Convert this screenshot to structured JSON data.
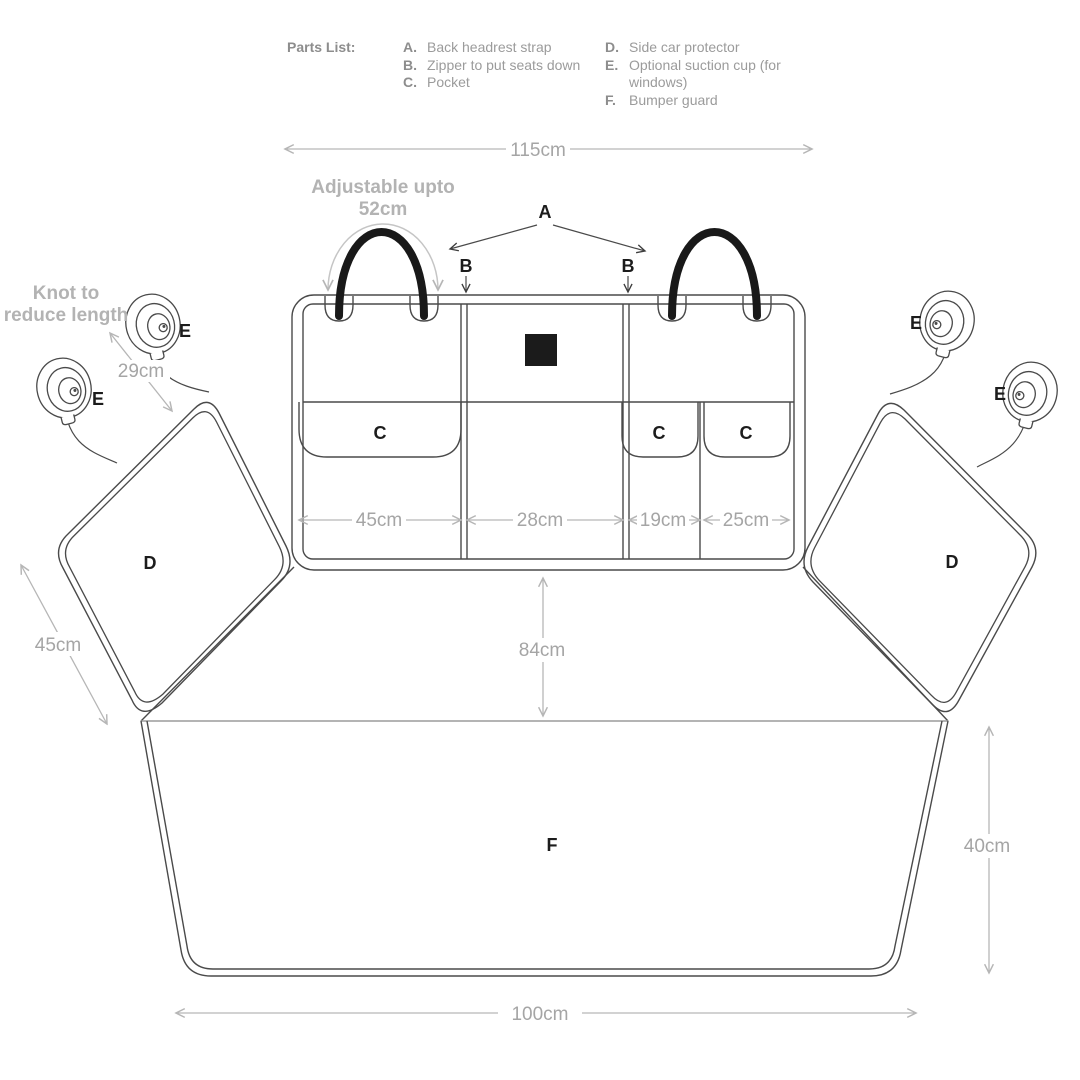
{
  "parts_list": {
    "title": "Parts List:",
    "columns": [
      {
        "items": [
          {
            "key": "A.",
            "label": "Back headrest strap"
          },
          {
            "key": "B.",
            "label": "Zipper to put seats down"
          },
          {
            "key": "C.",
            "label": "Pocket"
          }
        ]
      },
      {
        "items": [
          {
            "key": "D.",
            "label": "Side car protector"
          },
          {
            "key": "E.",
            "label": "Optional suction cup (for windows)"
          },
          {
            "key": "F.",
            "label": "Bumper guard"
          }
        ]
      }
    ]
  },
  "labels": {
    "headrest_strap": "A",
    "zipper_left": "B",
    "zipper_right": "B",
    "pocket_large": "C",
    "pocket_small_1": "C",
    "pocket_small_2": "C",
    "side_protector_left": "D",
    "side_protector_right": "D",
    "suction_left_upper": "E",
    "suction_left_lower": "E",
    "suction_right_upper": "E",
    "suction_right_lower": "E",
    "bumper_guard": "F"
  },
  "dimensions": {
    "top_width": "115cm",
    "strap_note_1": "Adjustable upto",
    "strap_note_2": "52cm",
    "knot_note_1": "Knot to",
    "knot_note_2": "reduce length",
    "string_length": "29cm",
    "pocket_large_width": "45cm",
    "middle_width": "28cm",
    "pocket_small_1_width": "19cm",
    "pocket_small_2_width": "25cm",
    "seat_depth": "84cm",
    "side_flap_width": "45cm",
    "bumper_height": "40cm",
    "bottom_width": "100cm"
  },
  "colors": {
    "outline": "#4a4a4a",
    "label_text": "#1c1c1c",
    "dim_line": "#b6b6b6",
    "dim_text": "#a5a5a5",
    "note_text": "#b3b3b3",
    "strap": "#191919",
    "logo_square": "#1b1b1b",
    "parts_key": "#8d8d8d",
    "parts_label": "#9b9b9b"
  }
}
